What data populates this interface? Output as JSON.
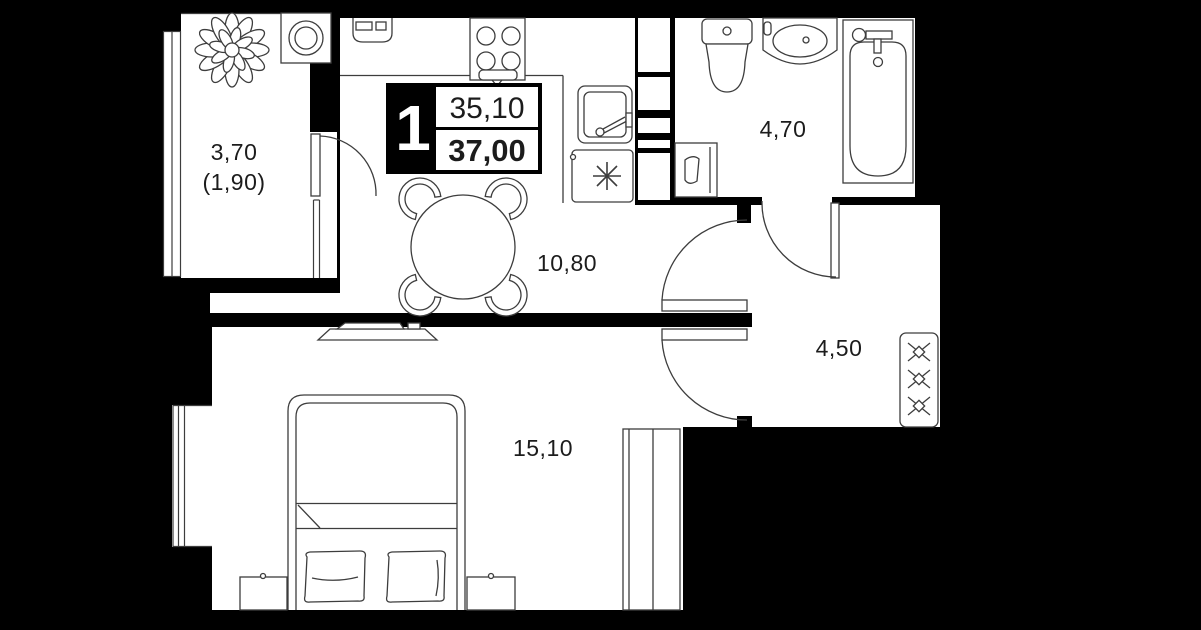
{
  "plan": {
    "badge": {
      "rooms": "1",
      "living_area": "35,10",
      "total_area": "37,00"
    },
    "rooms": {
      "balcony": {
        "area": "3,70",
        "area_alt": "(1,90)"
      },
      "kitchen_living": {
        "area": "10,80"
      },
      "bathroom": {
        "area": "4,70"
      },
      "hallway": {
        "area": "4,50"
      },
      "bedroom": {
        "area": "15,10"
      }
    },
    "colors": {
      "background": "#000000",
      "floor": "#ffffff",
      "stroke": "#3d3d3d",
      "text": "#1c1c1c"
    },
    "furniture": [
      "plant",
      "round-washer",
      "cooker-hood",
      "stove",
      "kitchen-sink",
      "washing-machine",
      "dining-table",
      "chair",
      "toilet",
      "vanity-sink",
      "bathtub",
      "bath-washer",
      "hall-wardrobe",
      "bed",
      "pillow",
      "nightstand",
      "tv",
      "bedroom-wardrobe",
      "window"
    ]
  }
}
